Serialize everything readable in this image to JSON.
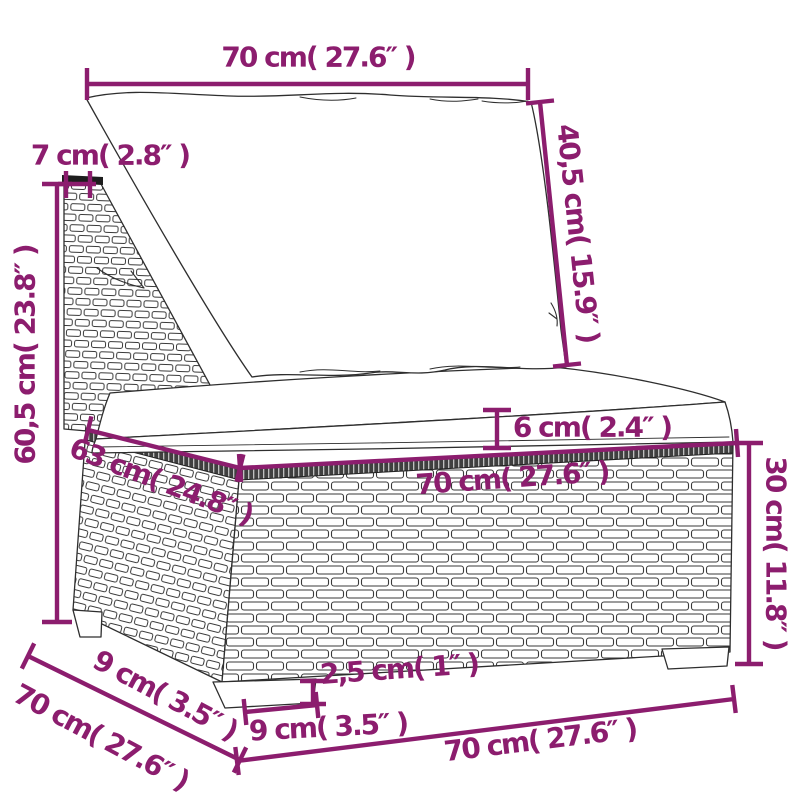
{
  "diagram": {
    "kind": "product-dimension-diagram",
    "subject": "poly-rattan garden sofa middle section with back cushion and seat cushion",
    "units": [
      "cm",
      "inches"
    ]
  },
  "colors": {
    "accent": "#8c1d6e",
    "artwork_line": "#2e2e2e",
    "weave_band": "#3f3f3f",
    "background": "#ffffff"
  },
  "labels": {
    "back_width": "70 cm( 27.6″ )",
    "frame_thickness": "7 cm( 2.8″ )",
    "back_cushion_height": "40,5 cm( 15.9″ )",
    "back_total_height": "60,5 cm( 23.8″ )",
    "seat_cushion_thickness": "6 cm( 2.4″ )",
    "seat_depth": "63 cm( 24.8″ )",
    "seat_width": "70 cm( 27.6″ )",
    "base_height": "30 cm( 11.8″ )",
    "leg_side_depth": "9 cm( 3.5″ )",
    "total_depth": "70 cm( 27.6″ )",
    "leg_height": "2,5 cm( 1″ )",
    "leg_front_width": "9 cm( 3.5″ )",
    "total_width": "70 cm( 27.6″ )"
  }
}
